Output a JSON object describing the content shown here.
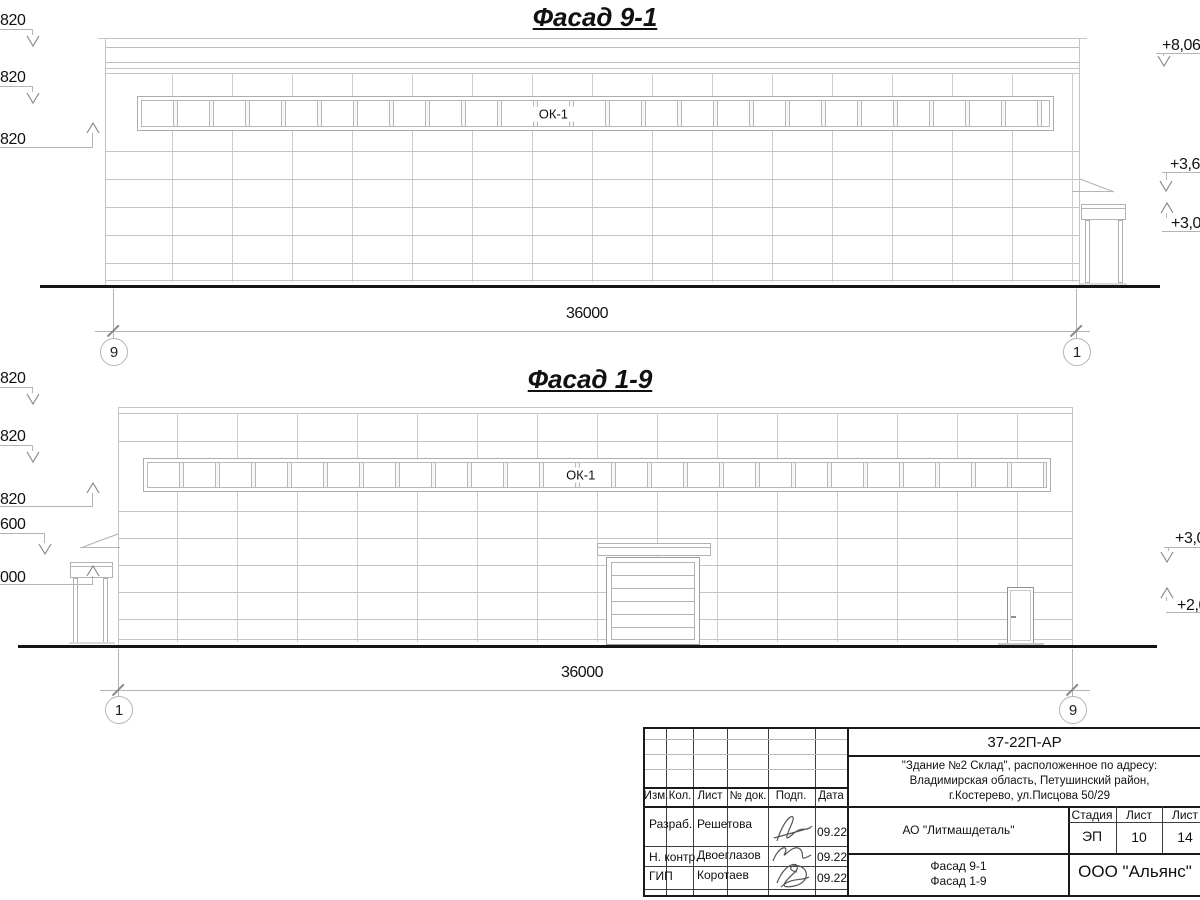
{
  "drawing": {
    "facade_top": {
      "title": "Фасад 9-1",
      "window_label": "ОК-1",
      "dimension": "36000",
      "axis_left": "9",
      "axis_right": "1",
      "elev_left": [
        "820",
        "820",
        "820"
      ],
      "elev_right": [
        "+8,06",
        "+3,60",
        "+3,00"
      ]
    },
    "facade_bottom": {
      "title": "Фасад 1-9",
      "window_label": "ОК-1",
      "dimension": "36000",
      "axis_left": "1",
      "axis_right": "9",
      "elev_left": [
        "820",
        "820",
        "820",
        "600",
        "000"
      ],
      "elev_right": [
        "+3,0",
        "+2,0"
      ]
    }
  },
  "titleblock": {
    "doc_number": "37-22П-АР",
    "address_lines": [
      "\"Здание №2 Склад\", расположенное по адресу:",
      "Владимирская область, Петушинский район,",
      "г.Костерево, ул.Писцова 50/29"
    ],
    "rev_headers": [
      "Изм.",
      "Кол.",
      "Лист",
      "№ док.",
      "Подп.",
      "Дата"
    ],
    "staff": [
      {
        "role": "Разраб.",
        "name": "Решетова",
        "date": "09.22"
      },
      {
        "role": "Н. контр.",
        "name": "Двоеглазов",
        "date": "09.22"
      },
      {
        "role": "ГИП",
        "name": "Коротаев",
        "date": "09.22"
      }
    ],
    "client": "АО \"Литмашдеталь\"",
    "stage_header": "Стадия",
    "sheet_header": "Лист",
    "sheets_header": "Лист",
    "stage": "ЭП",
    "sheet_number": "10",
    "sheet_count": "14",
    "sheet_title": [
      "Фасад 9-1",
      "Фасад 1-9"
    ],
    "organization": "ООО \"Альянс\""
  }
}
